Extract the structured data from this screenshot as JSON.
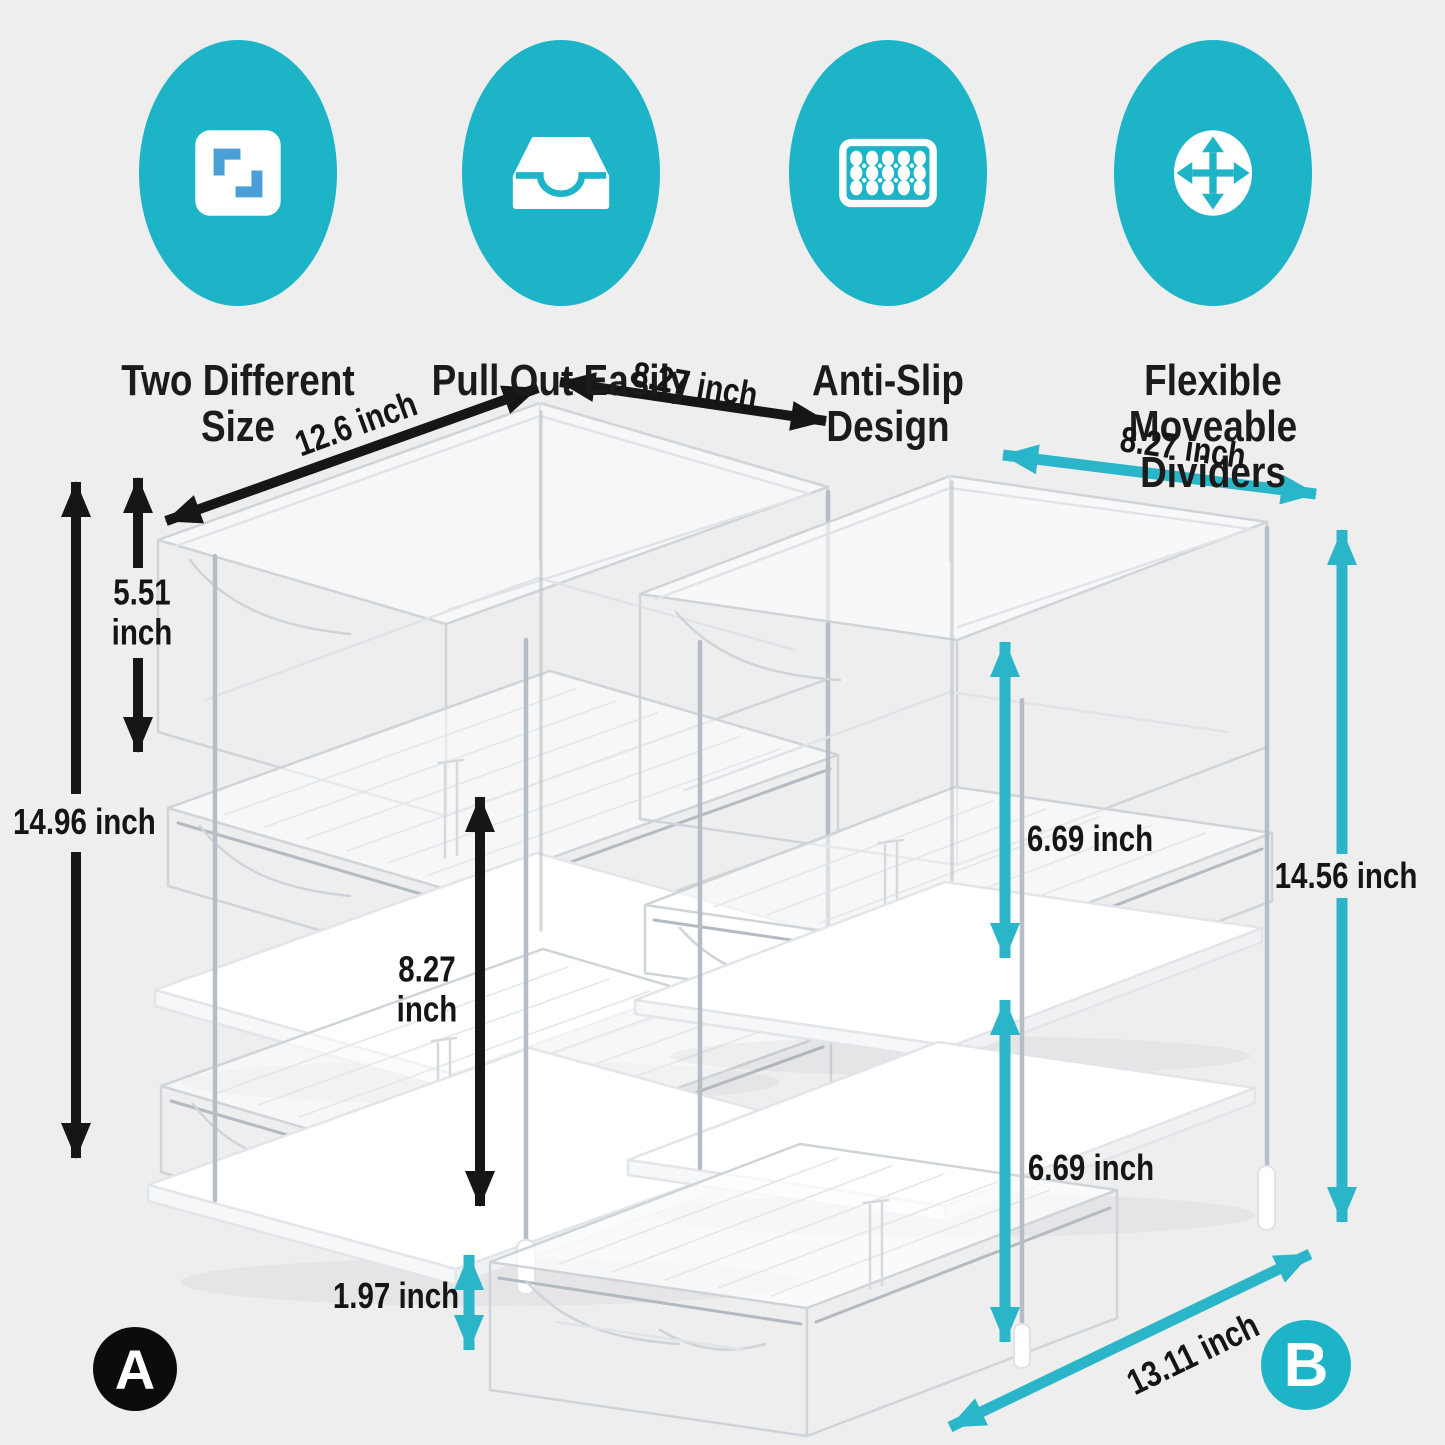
{
  "features": [
    {
      "icon": "two-sizes-icon",
      "label": "Two Different Size"
    },
    {
      "icon": "pull-out-drawer-icon",
      "label": "Pull Out Easily"
    },
    {
      "icon": "anti-slip-dots-icon",
      "label": "Anti-Slip Design"
    },
    {
      "icon": "move-arrows-icon",
      "label": "Flexible Moveable Dividers"
    }
  ],
  "units": {
    "a": {
      "badge": "A",
      "dimensions": {
        "length": "12.6 inch",
        "depth": "8.27 inch",
        "tier1_height": "5.51 inch",
        "total_height": "14.96 inch",
        "tier_gap": "8.27 inch",
        "tray_height": "1.97 inch"
      }
    },
    "b": {
      "badge": "B",
      "dimensions": {
        "width": "8.27 inch",
        "tier1_height": "6.69 inch",
        "total_height": "14.56 inch",
        "tier2_height": "6.69 inch",
        "depth": "13.11 inch"
      }
    }
  },
  "colors": {
    "background": "#eeeeef",
    "teal": "#1db4c8",
    "arrow_teal": "#2ab6c8",
    "icon_blue": "#4aa0d6",
    "ink": "#161616",
    "badge_a": "#0c0c0c",
    "wireframe": "#cfd4d9"
  }
}
